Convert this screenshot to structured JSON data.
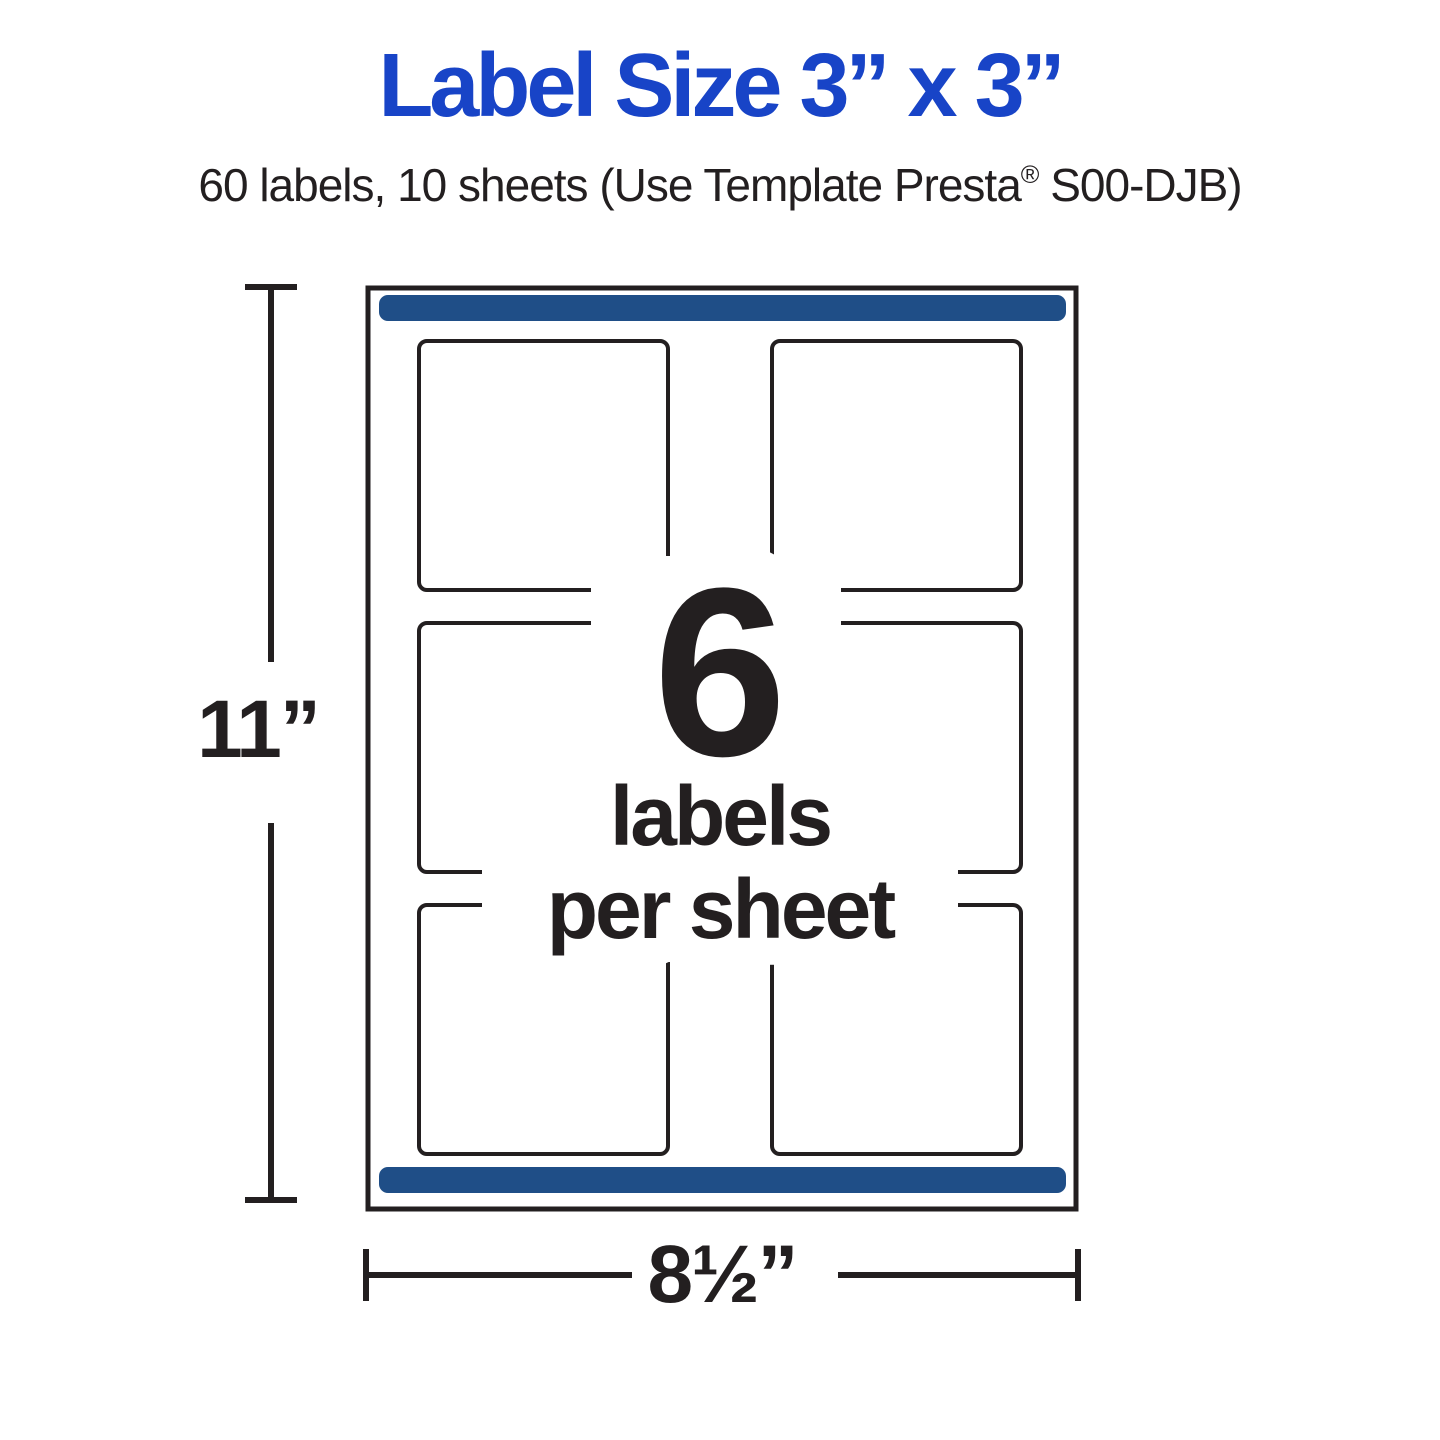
{
  "header": {
    "title": "Label Size 3” x 3”",
    "subtitle": {
      "pre": "60 labels, 10 sheets (Use Template Presta",
      "registered_mark": "®",
      "post": " S00-DJB)"
    }
  },
  "sheet_diagram": {
    "labels_count": "6",
    "caption_line1": "labels",
    "caption_line2": "per sheet",
    "height_dimension": "11”",
    "width_dimension": "8½”",
    "grid": {
      "rows": 3,
      "columns": 2
    },
    "colors": {
      "title_blue": "#1844c7",
      "bar_navy": "#1f4e87",
      "ink": "#231f20",
      "sheet_background": "#ffffff"
    }
  }
}
